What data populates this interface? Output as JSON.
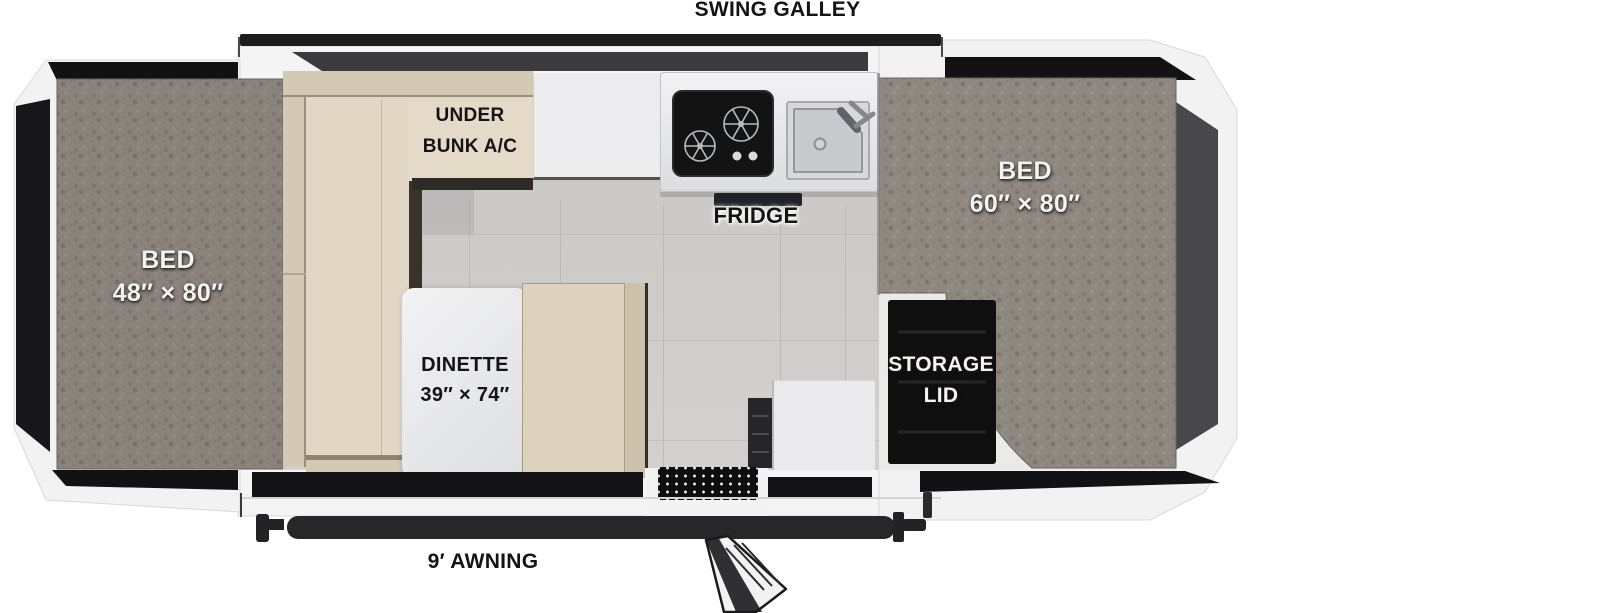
{
  "floorplan": {
    "labels": {
      "swing_galley": "SWING GALLEY",
      "awning": "9′ AWNING",
      "fridge": "FRIDGE",
      "front_bed": [
        "BED",
        "48″ × 80″"
      ],
      "rear_bed": [
        "BED",
        "60″ × 80″"
      ],
      "under_bunk_ac": [
        "UNDER",
        "BUNK A/C"
      ],
      "dinette": [
        "DINETTE",
        "39″ × 74″"
      ],
      "storage_lid": [
        "STORAGE",
        "LID"
      ]
    },
    "fixtures": [
      "swing-galley-rail",
      "two-burner-cooktop",
      "corner-sink",
      "fridge-under-counter",
      "dinette-table",
      "entry-step-grate",
      "entry-door-open",
      "awning-rail",
      "storage-lid-door"
    ]
  },
  "theme": {
    "page-bg": "#ffffff",
    "body-white": "#f4f4f5",
    "tent-black": "#121214",
    "end-panel-grey": "#48484b",
    "carpet-base": "#8f8880",
    "cushion": "#e1d7c4",
    "cushion-dark": "#d4c9b3",
    "cushion-edge": "#9a9080",
    "tile-grey": "#cbc9c6",
    "counter-grey": "#e9eaec",
    "rail-black": "#1d1d1f"
  }
}
